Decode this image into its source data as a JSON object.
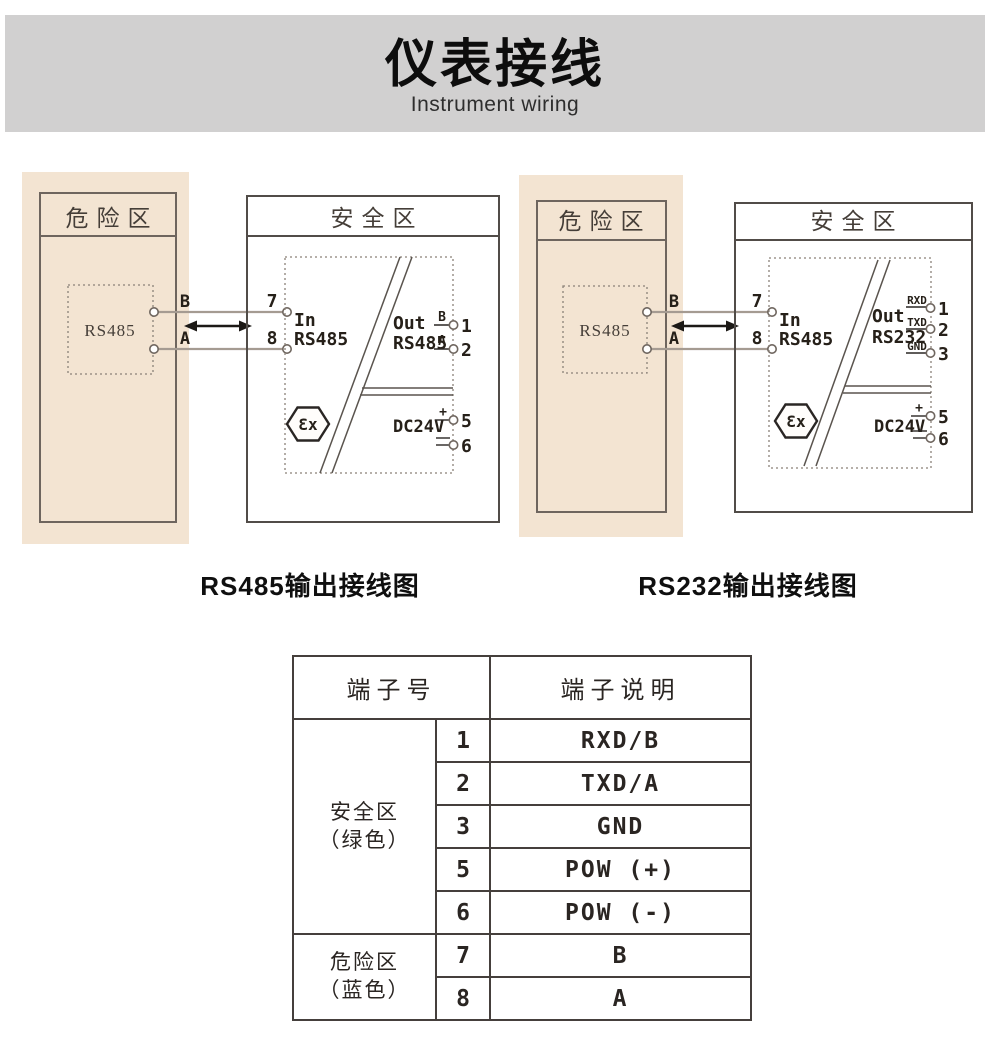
{
  "header": {
    "title": "仪表接线",
    "subtitle": "Instrument wiring"
  },
  "diagrams": [
    {
      "caption": "RS485输出接线图",
      "danger_label": "危险区",
      "safe_label": "安全区",
      "device": "RS485",
      "wire_top": "B",
      "wire_bottom": "A",
      "in_top_num": "7",
      "in_bottom_num": "8",
      "in_label": "In",
      "in_type": "RS485",
      "out_label": "Out",
      "out_type": "RS485",
      "out_terminals": [
        {
          "tag": "B",
          "num": "1"
        },
        {
          "tag": "A",
          "num": "2"
        }
      ],
      "power_label": "DC24V",
      "power_plus": "+",
      "power_plus_num": "5",
      "power_minus_num": "6",
      "ex_mark": "Ɛx"
    },
    {
      "caption": "RS232输出接线图",
      "danger_label": "危险区",
      "safe_label": "安全区",
      "device": "RS485",
      "wire_top": "B",
      "wire_bottom": "A",
      "in_top_num": "7",
      "in_bottom_num": "8",
      "in_label": "In",
      "in_type": "RS485",
      "out_label": "Out",
      "out_type": "RS232",
      "out_terminals": [
        {
          "tag": "RXD",
          "num": "1"
        },
        {
          "tag": "TXD",
          "num": "2"
        },
        {
          "tag": "GND",
          "num": "3"
        }
      ],
      "power_label": "DC24V",
      "power_plus": "+",
      "power_plus_num": "5",
      "power_minus_num": "6",
      "ex_mark": "Ɛx"
    }
  ],
  "table": {
    "col_terminal": "端子号",
    "col_desc": "端子说明",
    "groups": [
      {
        "zone": "安全区",
        "note": "（绿色）",
        "rows": [
          {
            "num": "1",
            "desc": "RXD/B"
          },
          {
            "num": "2",
            "desc": "TXD/A"
          },
          {
            "num": "3",
            "desc": "GND"
          },
          {
            "num": "5",
            "desc": "POW (+)"
          },
          {
            "num": "6",
            "desc": "POW (-)"
          }
        ]
      },
      {
        "zone": "危险区",
        "note": "（蓝色）",
        "rows": [
          {
            "num": "7",
            "desc": "B"
          },
          {
            "num": "8",
            "desc": "A"
          }
        ]
      }
    ]
  },
  "colors": {
    "header_band": "#d1d0d0",
    "danger_fill_outer": "#f3e4d2",
    "danger_fill_inner": "#f8eee3",
    "box_border": "#453f3c",
    "wire": "#a59b92"
  }
}
